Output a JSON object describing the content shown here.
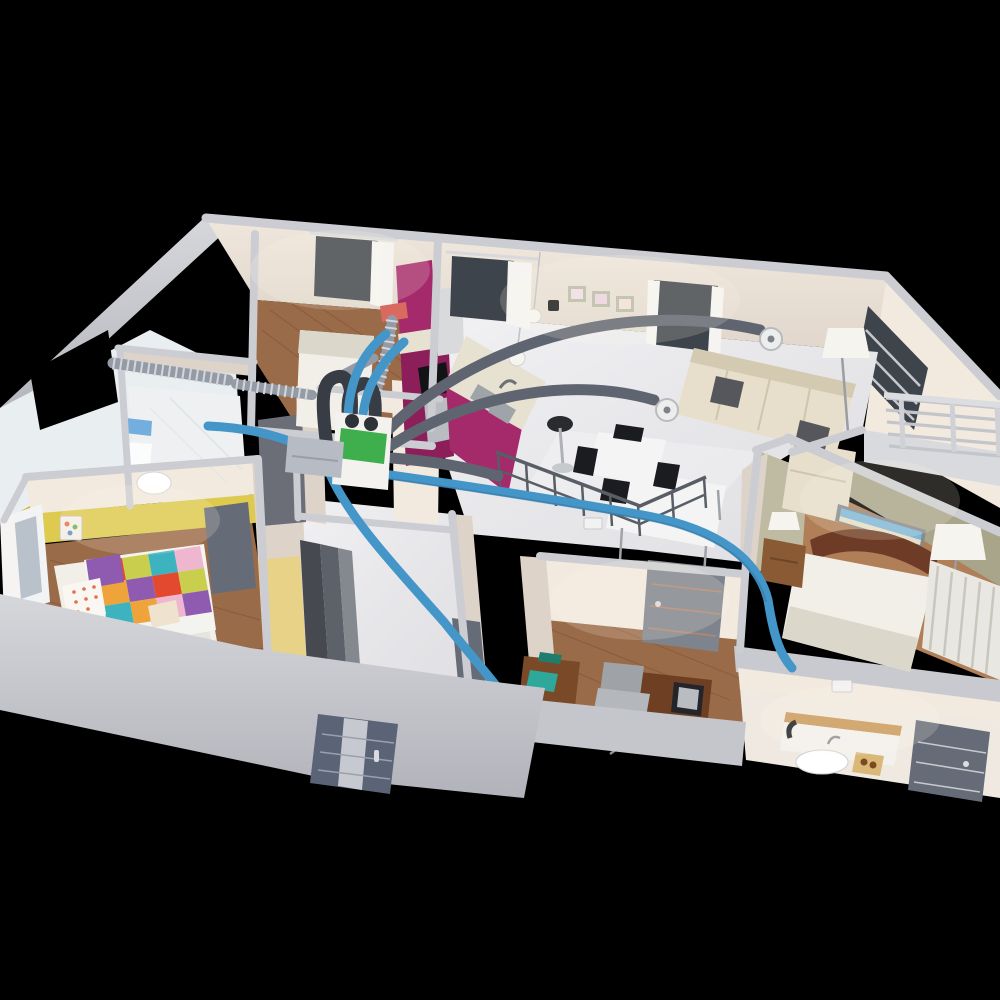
{
  "title": "3D cutaway floor plan render of an apartment with a heat-recovery ventilation (HRV) duct system",
  "colors": {
    "bg": "#000000",
    "outer_wall": "#c7c8cd",
    "outer_wall_dark": "#b3b4bb",
    "wall_cap": "#cccdd2",
    "wall_cream": "#f2e9df",
    "wall_cream_shadow": "#ddd3c9",
    "wall_deep_shadow": "#c4bab1",
    "floor_gloss": "#e9e9ec",
    "floor_gloss_hi": "#f8f8fa",
    "wood": "#9a6b49",
    "wood_dark": "#7f5336",
    "wood_light": "#b07e57",
    "kids_yellow": "#ddca4e",
    "kids_yellow_deep": "#cdb53a",
    "master_olive": "#a9a58b",
    "master_olive_light": "#bfbba2",
    "kitchen_magenta": "#a52a6b",
    "kitchen_magenta_dark": "#8c1f5a",
    "marble": "#e7e1d2",
    "duct_blue": "#4496c8",
    "duct_blue_dark": "#2f6f9c",
    "duct_gray": "#5f6570",
    "duct_dark": "#383c45",
    "corrugated": "#959ba5",
    "corrugated_ring": "#d3d7dd",
    "hrv_green": "#3fae4c",
    "manifold_gray": "#b7bbc3",
    "sofa_beige": "#e7dfcc",
    "sofa_shadow": "#d4cab2",
    "pillow_dark": "#55575c",
    "bed_white": "#f2efe8",
    "bed_shadow": "#dcd7cb",
    "headboard_brown": "#6e3c26",
    "door_gray": "#7e848e",
    "door_gray_dark": "#666c77",
    "entry_door": "#5b6377",
    "entry_stripe": "#c6c9cf",
    "glass_dark": "#3e444b",
    "glass_pale": "#b9c2ca",
    "curtain_white": "#f5f4f2",
    "vent_red": "#d96a5f",
    "table_white": "#f4f4f5",
    "chair_black": "#1b1c1f",
    "teal_accent": "#2ea89a",
    "quilt_red": "#e2492f",
    "quilt_orange": "#efa33b",
    "quilt_green": "#c9cf4d",
    "quilt_purple": "#8f5bb0",
    "quilt_teal": "#3db3c0",
    "quilt_pink": "#eeb7cf",
    "beach_sky": "#7db7d8",
    "beach_sand": "#e5dec8",
    "lamp_white": "#f6f4ef"
  },
  "scene": {
    "view": "elevated isometric cutaway, walls without ceiling, black background",
    "rooms": [
      {
        "name": "bedroom-top-left",
        "floor": "wood",
        "items": [
          "white-double-bed",
          "window-with-curtain"
        ]
      },
      {
        "name": "bathroom-left",
        "items": [
          "toilet",
          "blue-tile-strip",
          "corrugated-exterior-ducts",
          "open-window"
        ]
      },
      {
        "name": "kids-bedroom",
        "accent_wall": "yellow",
        "items": [
          "patchwork-quilt-bed",
          "purple-pillow",
          "dotted-pillow",
          "nightstand",
          "picture-frame",
          "window-with-curtains",
          "gray-door"
        ]
      },
      {
        "name": "kitchen",
        "cabinets": "magenta",
        "items": [
          "tall-cabinet",
          "fridge",
          "cooktop",
          "oven",
          "island-with-double-sink",
          "pendant-lamps",
          "bar-stool",
          "window-with-curtain",
          "red-exhaust-vent"
        ]
      },
      {
        "name": "living-dining",
        "items": [
          "corner-sofa-beige",
          "dark-pillows",
          "coffee-table-white",
          "floor-lamp",
          "dining-table",
          "black-chairs",
          "laptop",
          "stair-guard-railing",
          "three-wall-frames",
          "thermostat",
          "two-round-wall-vents",
          "tall-window"
        ]
      },
      {
        "name": "master-bedroom",
        "walls": "olive",
        "items": [
          "double-bed",
          "curved-wood-headboard",
          "beach-panorama-picture",
          "nightstand-with-lamp",
          "floor-lamp",
          "louver-door-wardrobe",
          "balcony-railing"
        ]
      },
      {
        "name": "office",
        "floor": "wood",
        "items": [
          "desk",
          "monitor",
          "keyboard",
          "office-chair",
          "side-table-with-teal-books",
          "gray-paneled-door",
          "wall-vent-grille"
        ]
      },
      {
        "name": "bathroom-bottom-right",
        "items": [
          "vanity-with-basin",
          "wood-shelf",
          "hair-dryer",
          "wood-tray",
          "gray-door",
          "wall-vent-grille"
        ]
      },
      {
        "name": "hallway",
        "items": [
          "dark-sliding-wardrobe",
          "crossing-blue-ducts"
        ]
      },
      {
        "name": "technical-closet",
        "items": [
          "hrv-unit-green-face",
          "gray-distribution-manifold",
          "black-flex-duct-loops",
          "blue-semi-rigid-ducts"
        ]
      }
    ],
    "entry": {
      "front_door": "dark blue-gray with light center stripe, set in large light-gray street-facing wall"
    },
    "ventilation": {
      "system": "heat-recovery ventilation",
      "hrv_unit": "white cabinet with green front and two round top ports",
      "supply_ducts": "blue semi-rigid, radiating from manifold to bathroom-left, kitchen, master side and bottom bathroom",
      "extract_ducts": "smooth dark-gray arcs ending in round white wall vents near sofa and dining area",
      "exterior_ducts": "silver corrugated segments across bathroom-left and along kitchen wall",
      "red_exhaust_vent_on_kitchen_cabinet": true,
      "round_wall_vent_count": 2,
      "rect_wall_grille_count": 2
    }
  }
}
